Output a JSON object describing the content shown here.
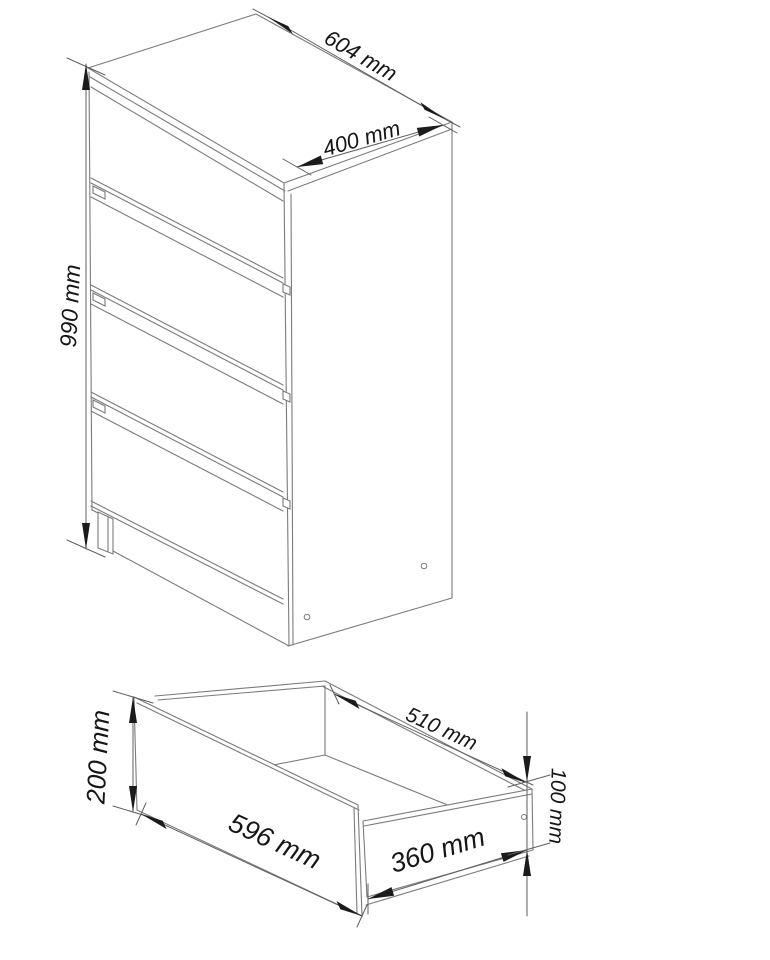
{
  "page": {
    "background": "#ffffff"
  },
  "drawing": {
    "type": "furniture dimension diagram",
    "line_color": "#7b7b7b",
    "dimension_color": "#5f5f5f",
    "text_color": "#161616",
    "cabinet_view": {
      "description": "Chest of drawers, perspective view, 4 drawer fronts, plinth leg, side panel with two holes",
      "drawer_count": 4,
      "dimensions": {
        "width": {
          "label": "604 mm"
        },
        "depth": {
          "label": "400 mm"
        },
        "height": {
          "label": "990 mm"
        }
      }
    },
    "drawer_view": {
      "description": "Single open drawer box, perspective view, side panel with one hole",
      "dimensions": {
        "front_height": {
          "label": "200 mm"
        },
        "front_width": {
          "label": "596 mm"
        },
        "inner_width": {
          "label": "510 mm"
        },
        "side_depth": {
          "label": "360 mm"
        },
        "side_height": {
          "label": "100 mm"
        }
      }
    }
  }
}
